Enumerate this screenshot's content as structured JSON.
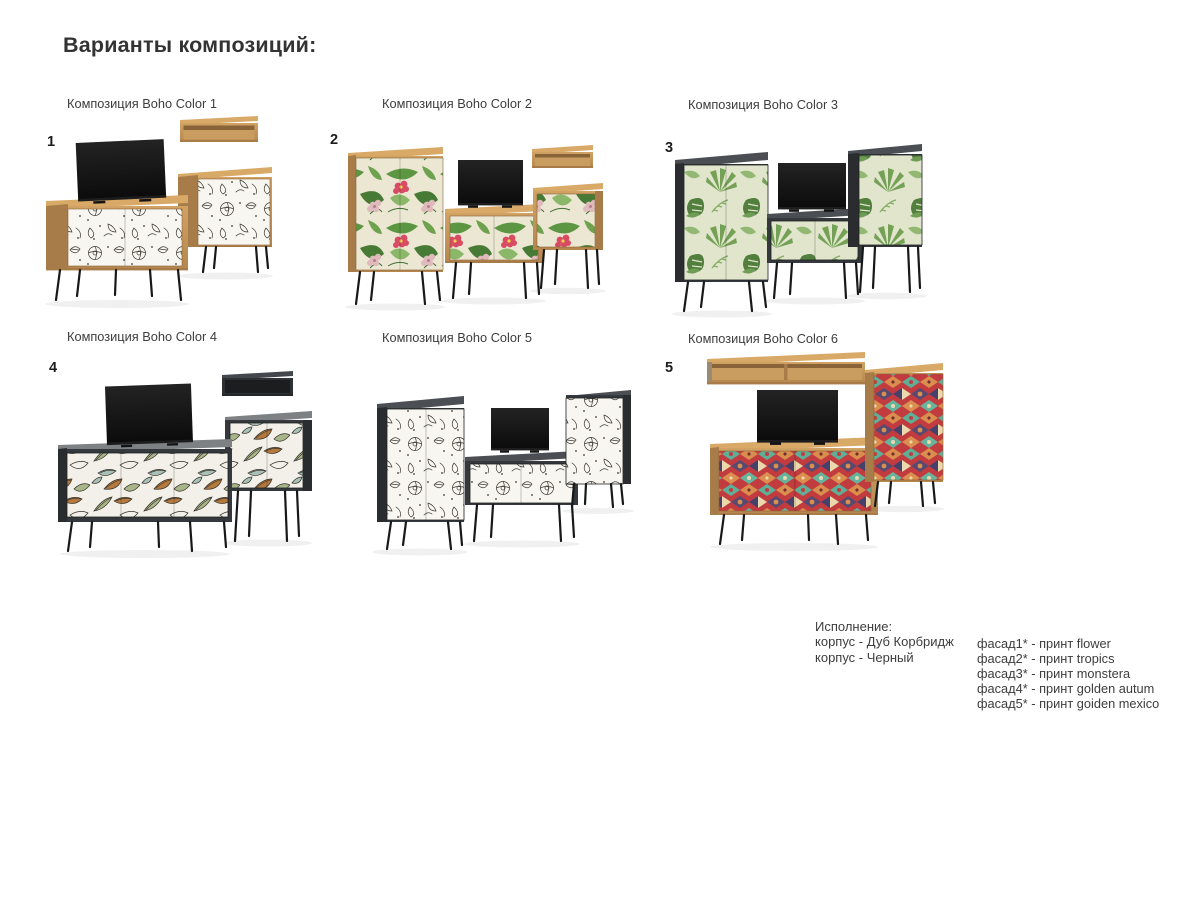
{
  "page": {
    "title": "Варианты композиций:"
  },
  "compositions": [
    {
      "number": "1",
      "label": "Композиция Boho Color 1",
      "print": "flower",
      "body": "Дуб Корбридж"
    },
    {
      "number": "2",
      "label": "Композиция Boho Color 2",
      "print": "tropics",
      "body": "Дуб Корбридж"
    },
    {
      "number": "3",
      "label": "Композиция Boho Color 3",
      "print": "monstera",
      "body": "Черный"
    },
    {
      "number": "4",
      "label": "Композиция Boho Color 4",
      "print": "golden autum",
      "body": "Черный"
    },
    {
      "number": "",
      "label": "Композиция Boho Color 5",
      "print": "flower",
      "body": "Черный"
    },
    {
      "number": "5",
      "label": "Композиция Boho Color 6",
      "print": "golden mexico",
      "body": "Дуб Корбридж"
    }
  ],
  "legend": {
    "title": "Исполнение:",
    "body_lines": [
      "корпус - Дуб Корбридж",
      "корпус - Черный"
    ],
    "facade_lines": [
      "фасад1* - принт flower",
      "фасад2* - принт tropics",
      "фасад3* - принт monstera",
      "фасад4* - принт golden autum",
      "фасад5* - принт goiden mexico"
    ]
  },
  "colors": {
    "background": "#ffffff",
    "text": "#3d3d3d",
    "oak": "#c79b5e",
    "oak_top": "#d8a967",
    "oak_shadow": "#a87c48",
    "black_body": "#35383c",
    "black_body_side": "#2a2c2f",
    "tv_screen": "#141414",
    "legs": "#17181a",
    "print_flower_bg": "#f8f6f0",
    "print_flower_line": "#3a382f",
    "print_tropics_bg": "#ebe7d3",
    "print_tropics_green": "#5d9643",
    "print_tropics_flower_red": "#d94b62",
    "print_tropics_flower_pink": "#dfb9bc",
    "print_monstera_bg": "#e0e5cc",
    "print_monstera_green": "#5b8a44",
    "print_autumn_bg": "#f2f0e8",
    "print_autumn_rust": "#b5793d",
    "print_autumn_sage": "#a9b489",
    "print_autumn_teal": "#a9c0b7",
    "print_mexico_red": "#c23b3f",
    "print_mexico_teal": "#5fae96",
    "print_mexico_orange": "#d98e4e",
    "print_mexico_purple": "#574a70",
    "print_mexico_cream": "#e9d9ac"
  }
}
